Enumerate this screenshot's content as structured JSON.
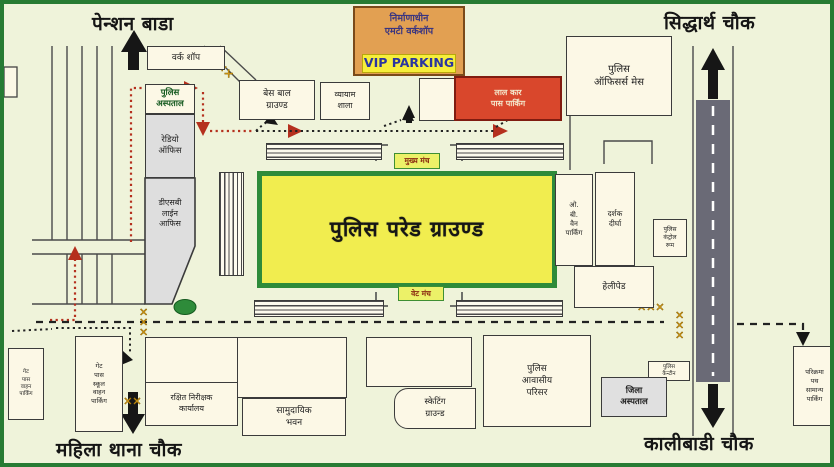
{
  "map": {
    "corners": {
      "top_left": "पेन्शन बाडा",
      "top_right": "सिद्धार्थ चौक",
      "bottom_left": "महिला थाना चौक",
      "bottom_right": "कालीबाडी चौक"
    },
    "buildings": {
      "workshop": "वर्क शॉप",
      "police_hospital": "पुलिस\nअस्पताल",
      "radio_office": "रेडियो\nऑफिस",
      "dsb_line_office": "डीएसबी\nलाईन\nआफिस",
      "baseball_ground": "बेस बाल\nग्राउण्ड",
      "vyayam_shala": "व्यायाम\nशाला",
      "mt_workshop": "निर्माणाधीन\nएमटी वर्कशॉप",
      "vip_parking": "VIP PARKING",
      "car_pass_parking": "लाल कार\nपास पार्किंग",
      "officers_mess": "पुलिस\nऑफिसर्स मेस",
      "parade_ground": "पुलिस परेड ग्राउण्ड",
      "main_stage": "मुख्य मंच",
      "vet_stage": "वेट मंच",
      "ob_van_parking": "ओ.\nबी.\nवैन\nपार्किंग",
      "spectator_gallery": "दर्शक\nदीर्घा",
      "helipad": "हेलीपेड",
      "control_room": "पुलिस\nकंट्रोल\nरूम",
      "canteen": "पुलिस\nकैन्टीन",
      "district_hospital": "जिला\nअस्पताल",
      "police_residential": "पुलिस\nआवासीय\nपरिसर",
      "skating_ground": "स्केटिंग\nग्राउन्ड",
      "community_hall": "सामुदायिक\nभवन",
      "reserve_inspector_office": "रक्षित निरीक्षक\nकार्यालय",
      "gate_pass_parking": "गेट\nपास\nस्कूल\nवाहन\nपार्किंग",
      "left_edge_parking": "गेट\nपास\nवाहन\nपार्किंग",
      "parikrama_parking": "परिक्रमा\nपथ\nसामान्य\nपार्किंग"
    },
    "colors": {
      "page_bg": "#eff3da",
      "frame_green": "#277b33",
      "parade_yellow": "#f1ed4f",
      "parade_border_green": "#2e8b3a",
      "mt_workshop_orange": "#e2a052",
      "vip_yellow": "#f6ee3a",
      "restricted_red": "#d9472c",
      "road_gray": "#6a6a76",
      "barricade_yellow": "#e8a516",
      "route_red": "#b5301e",
      "route_black": "#222222"
    }
  }
}
